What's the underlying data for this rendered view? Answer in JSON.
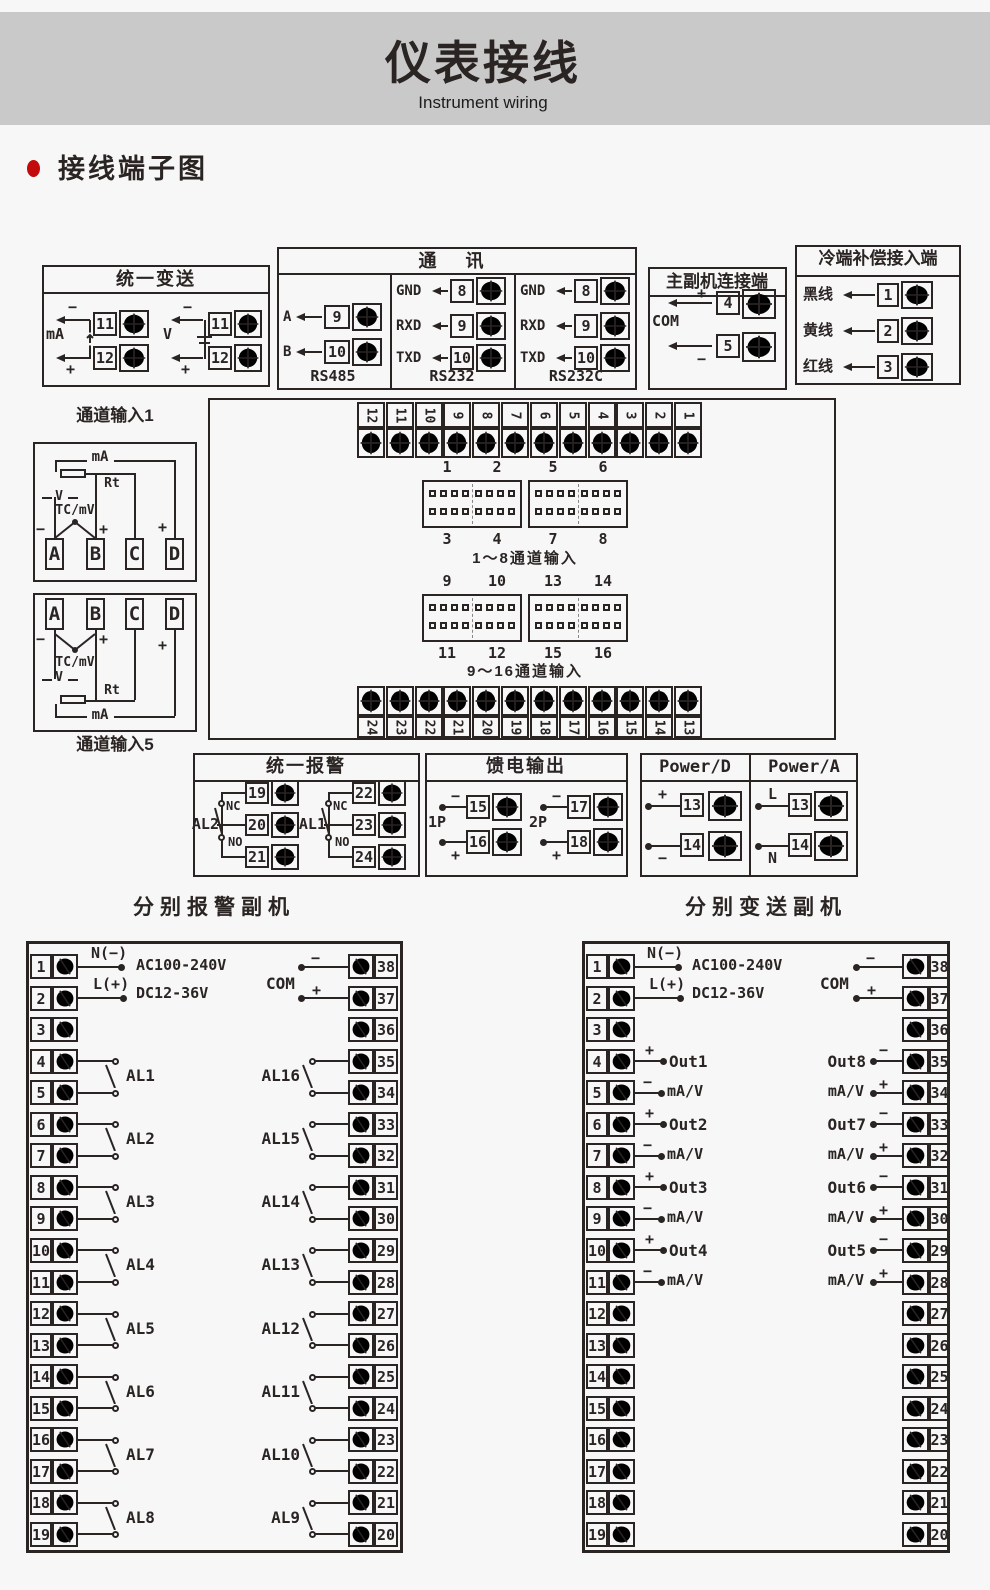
{
  "page": {
    "title": "仪表接线",
    "subtitle": "Instrument wiring",
    "section_heading": "接线端子图"
  },
  "colors": {
    "header_bg": "#c9c9c9",
    "page_bg": "#f7f7f7",
    "line": "#2a2423",
    "accent_red": "#c30b0b"
  },
  "unified_transmit": {
    "title": "统一变送",
    "groups": [
      {
        "label": "mA",
        "minus": "−",
        "plus": "+",
        "terminals": [
          "11",
          "12"
        ]
      },
      {
        "label": "V",
        "minus": "−",
        "plus": "+",
        "terminals": [
          "11",
          "12"
        ]
      }
    ]
  },
  "communication": {
    "title": "通 讯",
    "columns": [
      {
        "name": "RS485",
        "rows": [
          {
            "label": "A",
            "terminal": "9"
          },
          {
            "label": "B",
            "terminal": "10"
          }
        ]
      },
      {
        "name": "RS232",
        "rows": [
          {
            "label": "GND",
            "terminal": "8"
          },
          {
            "label": "RXD",
            "terminal": "9"
          },
          {
            "label": "TXD",
            "terminal": "10"
          }
        ]
      },
      {
        "name": "RS232C",
        "rows": [
          {
            "label": "GND",
            "terminal": "8"
          },
          {
            "label": "RXD",
            "terminal": "9"
          },
          {
            "label": "TXD",
            "terminal": "10"
          }
        ]
      }
    ]
  },
  "master_slave": {
    "title": "主副机连接端",
    "com": "COM",
    "rows": [
      {
        "sign": "+",
        "terminal": "4"
      },
      {
        "sign": "−",
        "terminal": "5"
      }
    ]
  },
  "cold_junction": {
    "title": "冷端补偿接入端",
    "rows": [
      {
        "label": "黑线",
        "terminal": "1"
      },
      {
        "label": "黄线",
        "terminal": "2"
      },
      {
        "label": "红线",
        "terminal": "3"
      }
    ]
  },
  "center_block": {
    "top_terminals": [
      "12",
      "11",
      "10",
      "9",
      "8",
      "7",
      "6",
      "5",
      "4",
      "3",
      "2",
      "1"
    ],
    "bottom_terminals": [
      "24",
      "23",
      "22",
      "21",
      "20",
      "19",
      "18",
      "17",
      "16",
      "15",
      "14",
      "13"
    ],
    "groups": [
      {
        "top_labels": [
          "1",
          "2",
          "5",
          "6"
        ],
        "bottom_labels": [
          "3",
          "4",
          "7",
          "8"
        ],
        "caption": "1～8通道输入"
      },
      {
        "top_labels": [
          "9",
          "10",
          "13",
          "14"
        ],
        "bottom_labels": [
          "11",
          "12",
          "15",
          "16"
        ],
        "caption": "9～16通道输入"
      }
    ]
  },
  "channel_input_1": {
    "label": "通道输入1",
    "ma": "mA",
    "rt": "Rt",
    "v": "V",
    "tc": "TC/mV",
    "minus": "−",
    "plus": "+",
    "terminals": [
      "A",
      "B",
      "C",
      "D"
    ]
  },
  "channel_input_5": {
    "label": "通道输入5",
    "ma": "mA",
    "rt": "Rt",
    "v": "V",
    "tc": "TC/mV",
    "minus": "−",
    "plus": "+",
    "terminals": [
      "A",
      "B",
      "C",
      "D"
    ]
  },
  "unified_alarm": {
    "title": "统一报警",
    "relays": [
      {
        "name": "AL2",
        "nc": "NC",
        "no": "NO",
        "terminals": [
          "19",
          "20",
          "21"
        ]
      },
      {
        "name": "AL1",
        "nc": "NC",
        "no": "NO",
        "terminals": [
          "22",
          "23",
          "24"
        ]
      }
    ]
  },
  "feed_output": {
    "title": "馈电输出",
    "groups": [
      {
        "name": "1P",
        "rows": [
          {
            "sign": "−",
            "terminal": "15"
          },
          {
            "sign": "+",
            "terminal": "16"
          }
        ]
      },
      {
        "name": "2P",
        "rows": [
          {
            "sign": "−",
            "terminal": "17"
          },
          {
            "sign": "+",
            "terminal": "18"
          }
        ]
      }
    ]
  },
  "power": {
    "columns": [
      {
        "title": "Power/D",
        "rows": [
          {
            "sign": "+",
            "terminal": "13"
          },
          {
            "sign": "−",
            "terminal": "14"
          }
        ]
      },
      {
        "title": "Power/A",
        "rows": [
          {
            "sign": "L",
            "terminal": "13"
          },
          {
            "sign": "N",
            "terminal": "14"
          }
        ]
      }
    ]
  },
  "alarm_slave": {
    "title": "分别报警副机",
    "left_terminals": [
      "1",
      "2",
      "3",
      "4",
      "5",
      "6",
      "7",
      "8",
      "9",
      "10",
      "11",
      "12",
      "13",
      "14",
      "15",
      "16",
      "17",
      "18",
      "19"
    ],
    "right_terminals": [
      "38",
      "37",
      "36",
      "35",
      "34",
      "33",
      "32",
      "31",
      "30",
      "29",
      "28",
      "27",
      "26",
      "25",
      "24",
      "23",
      "22",
      "21",
      "20"
    ],
    "power": {
      "n_label": "N(−)",
      "l_label": "L(+)",
      "ac": "AC100-240V",
      "dc": "DC12-36V"
    },
    "com": {
      "label": "COM",
      "minus": "−",
      "plus": "+"
    },
    "left_relays": [
      "AL1",
      "AL2",
      "AL3",
      "AL4",
      "AL5",
      "AL6",
      "AL7",
      "AL8"
    ],
    "right_relays": [
      "AL16",
      "AL15",
      "AL14",
      "AL13",
      "AL12",
      "AL11",
      "AL10",
      "AL9"
    ]
  },
  "transmit_slave": {
    "title": "分别变送副机",
    "left_terminals": [
      "1",
      "2",
      "3",
      "4",
      "5",
      "6",
      "7",
      "8",
      "9",
      "10",
      "11",
      "12",
      "13",
      "14",
      "15",
      "16",
      "17",
      "18",
      "19"
    ],
    "right_terminals": [
      "38",
      "37",
      "36",
      "35",
      "34",
      "33",
      "32",
      "31",
      "30",
      "29",
      "28",
      "27",
      "26",
      "25",
      "24",
      "23",
      "22",
      "21",
      "20"
    ],
    "power": {
      "n_label": "N(−)",
      "l_label": "L(+)",
      "ac": "AC100-240V",
      "dc": "DC12-36V"
    },
    "com": {
      "label": "COM",
      "minus": "−",
      "plus": "+"
    },
    "left_outputs": [
      {
        "name": "Out1",
        "unit": "mA/V",
        "plus": "+",
        "minus": "−"
      },
      {
        "name": "Out2",
        "unit": "mA/V",
        "plus": "+",
        "minus": "−"
      },
      {
        "name": "Out3",
        "unit": "mA/V",
        "plus": "+",
        "minus": "−"
      },
      {
        "name": "Out4",
        "unit": "mA/V",
        "plus": "+",
        "minus": "−"
      }
    ],
    "right_outputs": [
      {
        "name": "Out8",
        "unit": "mA/V",
        "plus": "+",
        "minus": "−"
      },
      {
        "name": "Out7",
        "unit": "mA/V",
        "plus": "+",
        "minus": "−"
      },
      {
        "name": "Out6",
        "unit": "mA/V",
        "plus": "+",
        "minus": "−"
      },
      {
        "name": "Out5",
        "unit": "mA/V",
        "plus": "+",
        "minus": "−"
      }
    ]
  }
}
